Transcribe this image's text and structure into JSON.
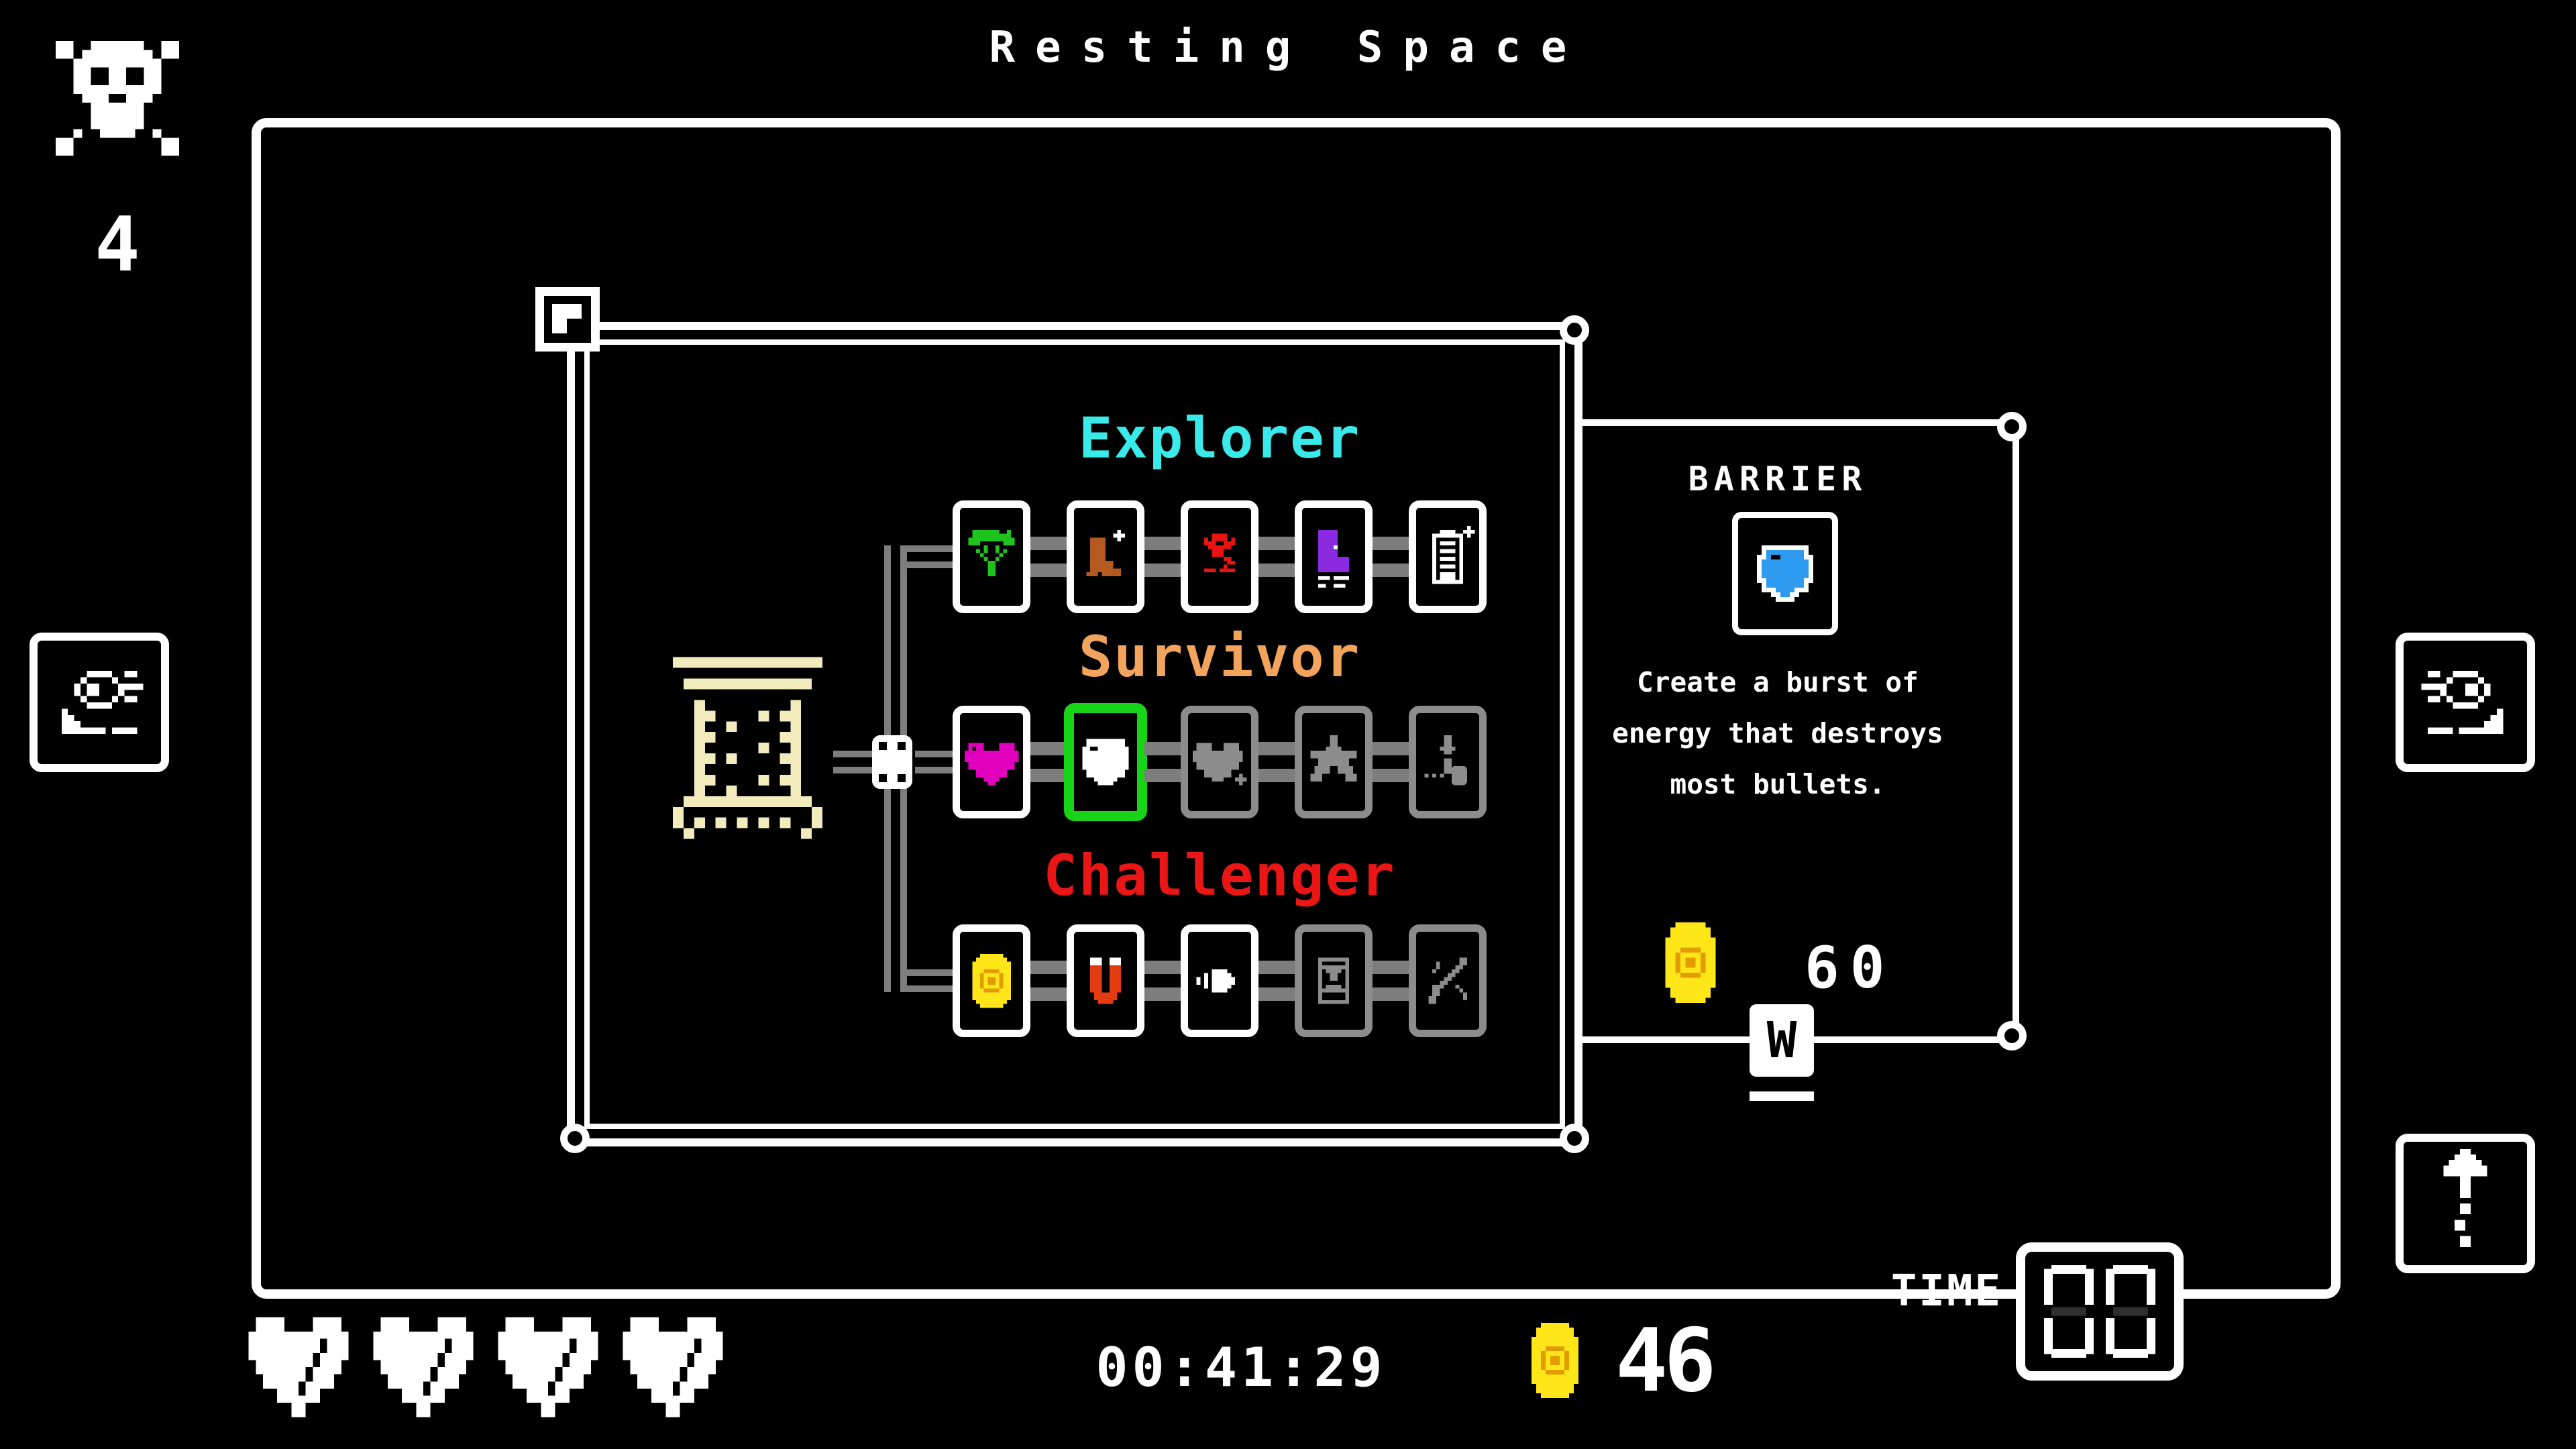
{
  "header": {
    "title": "Resting Space"
  },
  "hud": {
    "deaths": "4",
    "hearts_count": 4,
    "timer": "00:41:29",
    "coins": "46",
    "time_label": "TIME",
    "time_display": "00"
  },
  "skill_tree": {
    "branches": [
      {
        "name": "Explorer",
        "color": "#3ae9e9",
        "skills": [
          {
            "icon": "parachute-icon",
            "state": "unlocked"
          },
          {
            "icon": "dash-boot-icon",
            "state": "unlocked"
          },
          {
            "icon": "scout-drone-icon",
            "state": "unlocked"
          },
          {
            "icon": "skate-icon",
            "state": "unlocked"
          },
          {
            "icon": "battery-plus-icon",
            "state": "unlocked"
          }
        ]
      },
      {
        "name": "Survivor",
        "color": "#f2a45c",
        "skills": [
          {
            "icon": "heart-icon",
            "state": "unlocked"
          },
          {
            "icon": "barrier-shield-icon",
            "state": "selected"
          },
          {
            "icon": "heart-plus-icon",
            "state": "locked"
          },
          {
            "icon": "star-icon",
            "state": "locked"
          },
          {
            "icon": "revive-icon",
            "state": "locked"
          }
        ]
      },
      {
        "name": "Challenger",
        "color": "#ea1616",
        "skills": [
          {
            "icon": "coin-icon",
            "state": "unlocked"
          },
          {
            "icon": "magnet-icon",
            "state": "unlocked"
          },
          {
            "icon": "bullet-icon",
            "state": "unlocked"
          },
          {
            "icon": "hourglass-icon",
            "state": "locked"
          },
          {
            "icon": "sword-icon",
            "state": "locked"
          }
        ]
      }
    ]
  },
  "detail_panel": {
    "title": "BARRIER",
    "icon": "blue-shield-icon",
    "description": "Create a burst of energy that destroys most bullets.",
    "cost": "60",
    "key_hint": "W"
  },
  "colors": {
    "background": "#000000",
    "frame": "#ffffff",
    "track_gray": "#7d7d7d",
    "locked_gray": "#8c8c8c",
    "selected_green": "#17d417",
    "explorer_cyan": "#3ae9e9",
    "survivor_orange": "#f2a45c",
    "challenger_red": "#ea1616",
    "coin_yellow": "#ffe619",
    "coin_orange": "#e39c00",
    "heart_magenta": "#e100bd",
    "shield_blue": "#2e9bf0",
    "parachute_green": "#1ec41e",
    "boot_brown": "#b45a20",
    "skate_purple": "#8a2be2",
    "magnet_red": "#e23c10",
    "door_cream": "#f2ecbc"
  }
}
